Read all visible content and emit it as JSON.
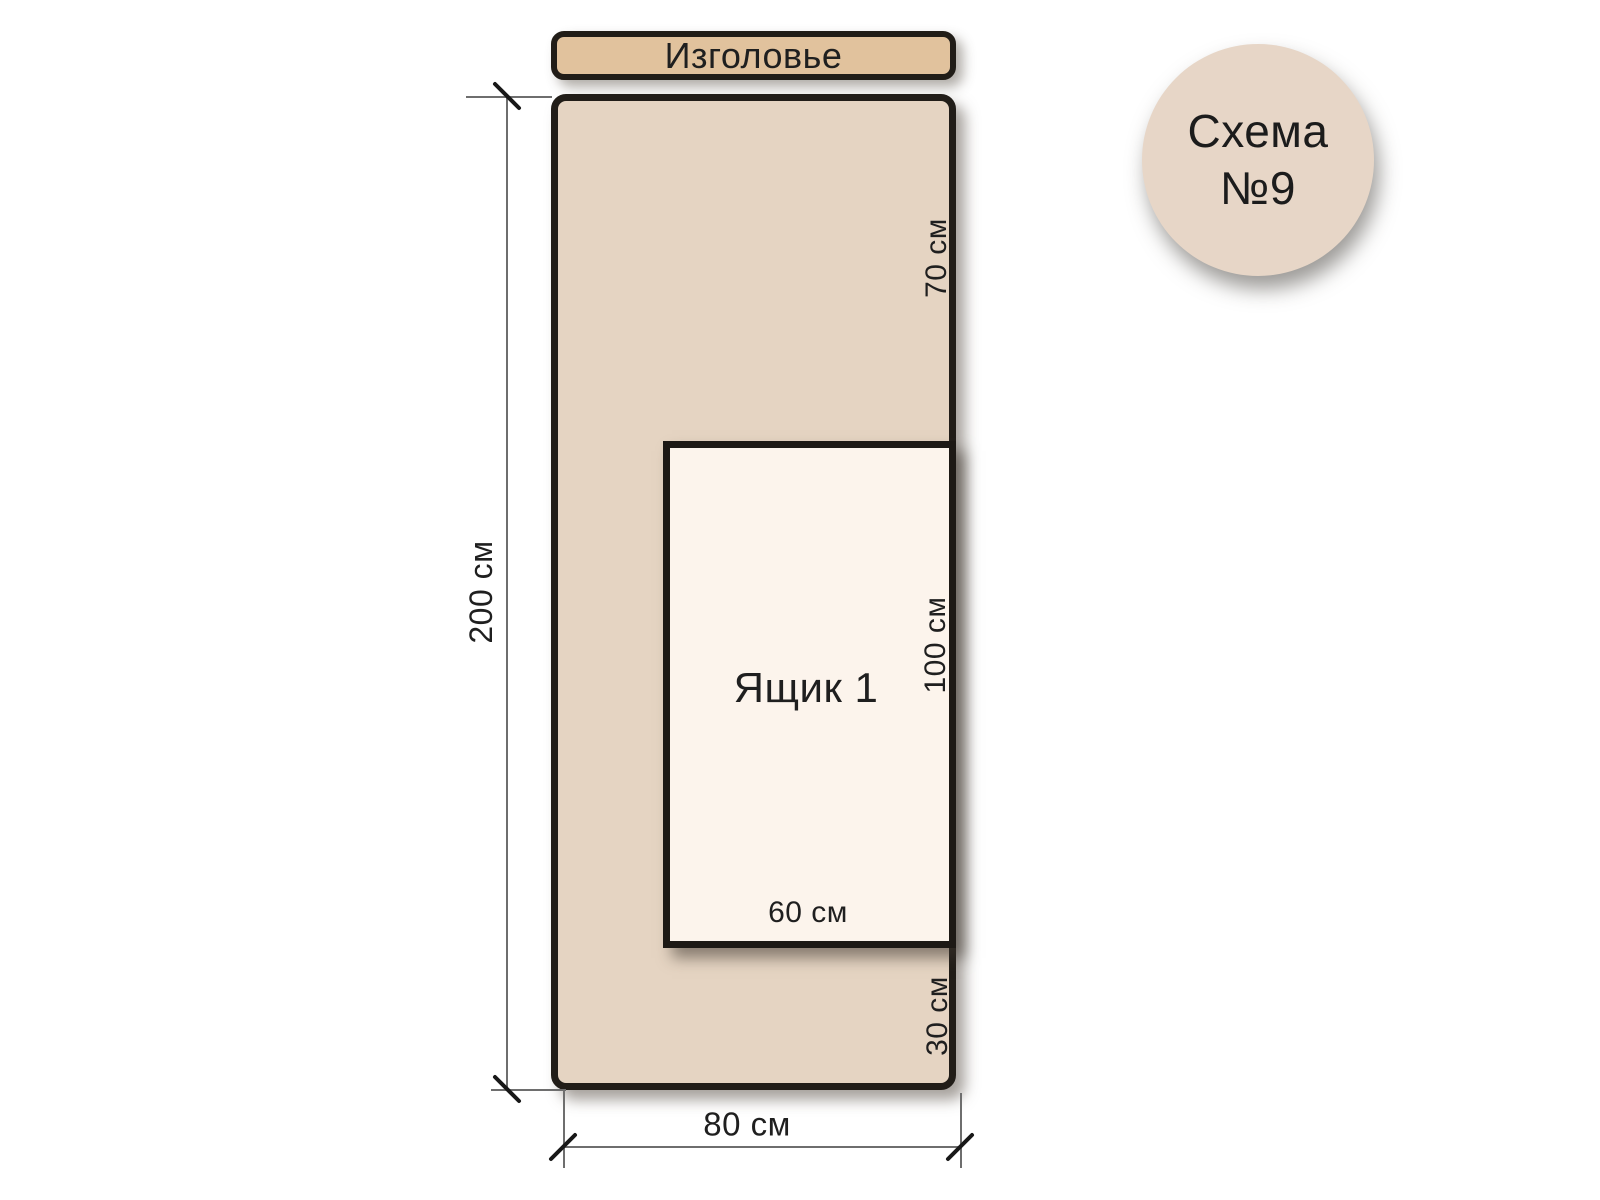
{
  "badge": {
    "title_line1": "Схема",
    "title_line2": "№9"
  },
  "headboard": {
    "label": "Изголовье"
  },
  "bed": {
    "height_label": "200 см",
    "width_label": "80 см",
    "upper_section_label": "70 см",
    "lower_section_label": "30 см"
  },
  "drawer": {
    "label": "Ящик 1",
    "height_label": "100 см",
    "width_label": "60 см"
  },
  "colors": {
    "background": "#ffffff",
    "headboard_fill": "#e1c29d",
    "bed_fill": "#e5d4c2",
    "drawer_fill": "#fcf4ec",
    "badge_fill": "#e7d6c7",
    "outline": "#211d18",
    "dimension_line": "#6e6e6e",
    "text": "#1f1f1f"
  }
}
